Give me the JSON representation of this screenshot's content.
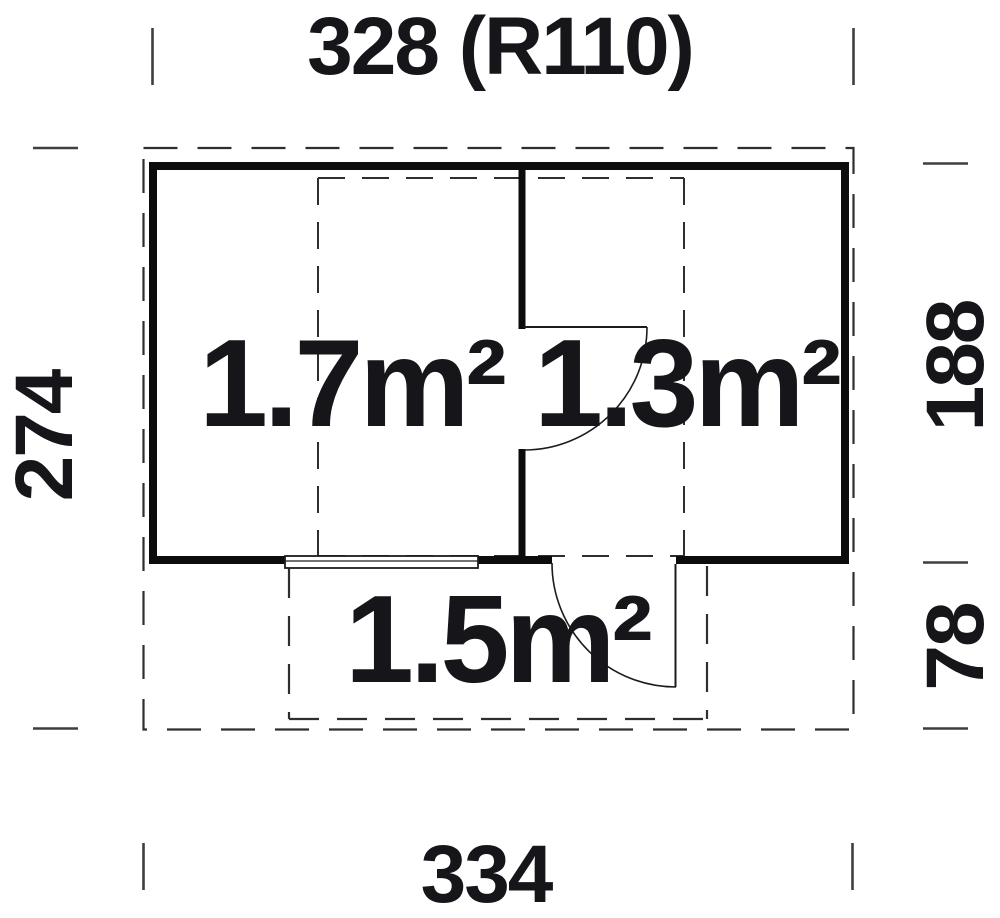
{
  "diagram": {
    "type": "floor-plan",
    "dimensions": {
      "width_top": "328 (R110)",
      "depth_left": "274",
      "depth_right_main": "188",
      "depth_right_porch": "78",
      "width_bottom": "334"
    },
    "rooms": [
      {
        "name": "left-room",
        "area_label": "1.7m²"
      },
      {
        "name": "right-room",
        "area_label": "1.3m²"
      },
      {
        "name": "porch",
        "area_label": "1.5m²"
      }
    ],
    "colors": {
      "background": "#ffffff",
      "wall": "#0c0c0c",
      "dashed_line": "#2e2e2e",
      "thin_line": "#1c1c1c",
      "tick": "#3f3f3f",
      "text": "#15151a"
    }
  }
}
